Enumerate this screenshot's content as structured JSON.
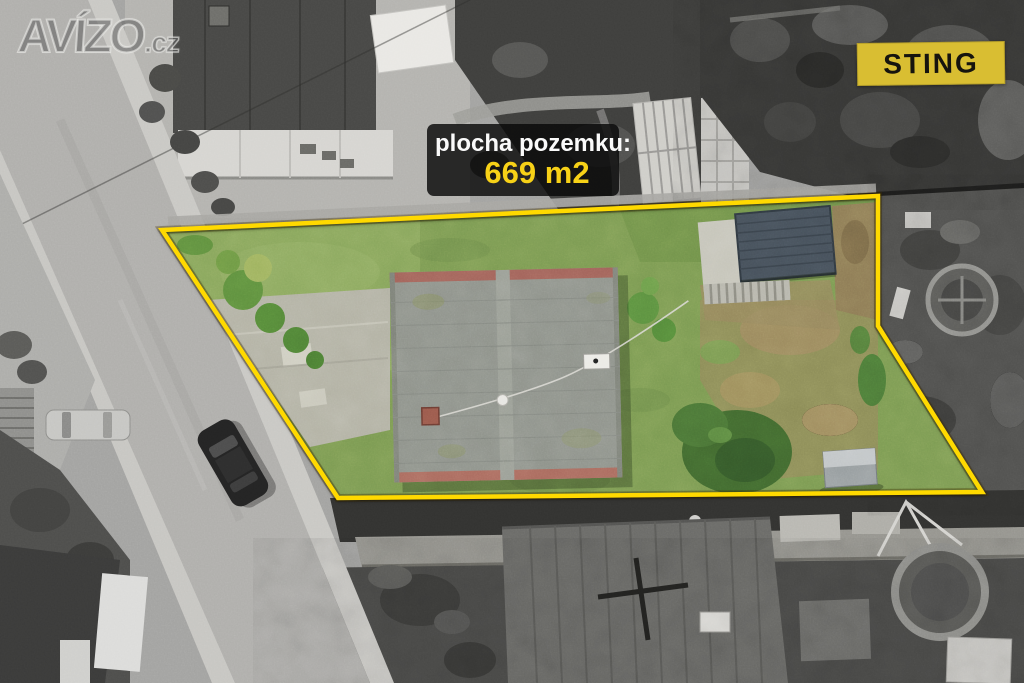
{
  "watermark": {
    "name": "AVÍZO",
    "suffix": ".cz"
  },
  "agency_badge": {
    "label": "STING"
  },
  "plot_label": {
    "line1": "plocha pozemku:",
    "line2": "669 m2"
  },
  "boundary": {
    "points": "162,230 878,196 878,326 982,492 338,498",
    "stroke_width": 4.5
  },
  "colors": {
    "boundary-yellow": "#ffd800",
    "badge-yellow": "#d9be32",
    "value-yellow": "#f7d117",
    "info-bg": "rgba(8,8,8,0.82)",
    "grass-green": "#7b9a52",
    "roof-gray": "#8e928a",
    "ridge-red": "#a2635a",
    "shed-slate": "#46505a",
    "road-gray": "#b0afac"
  }
}
